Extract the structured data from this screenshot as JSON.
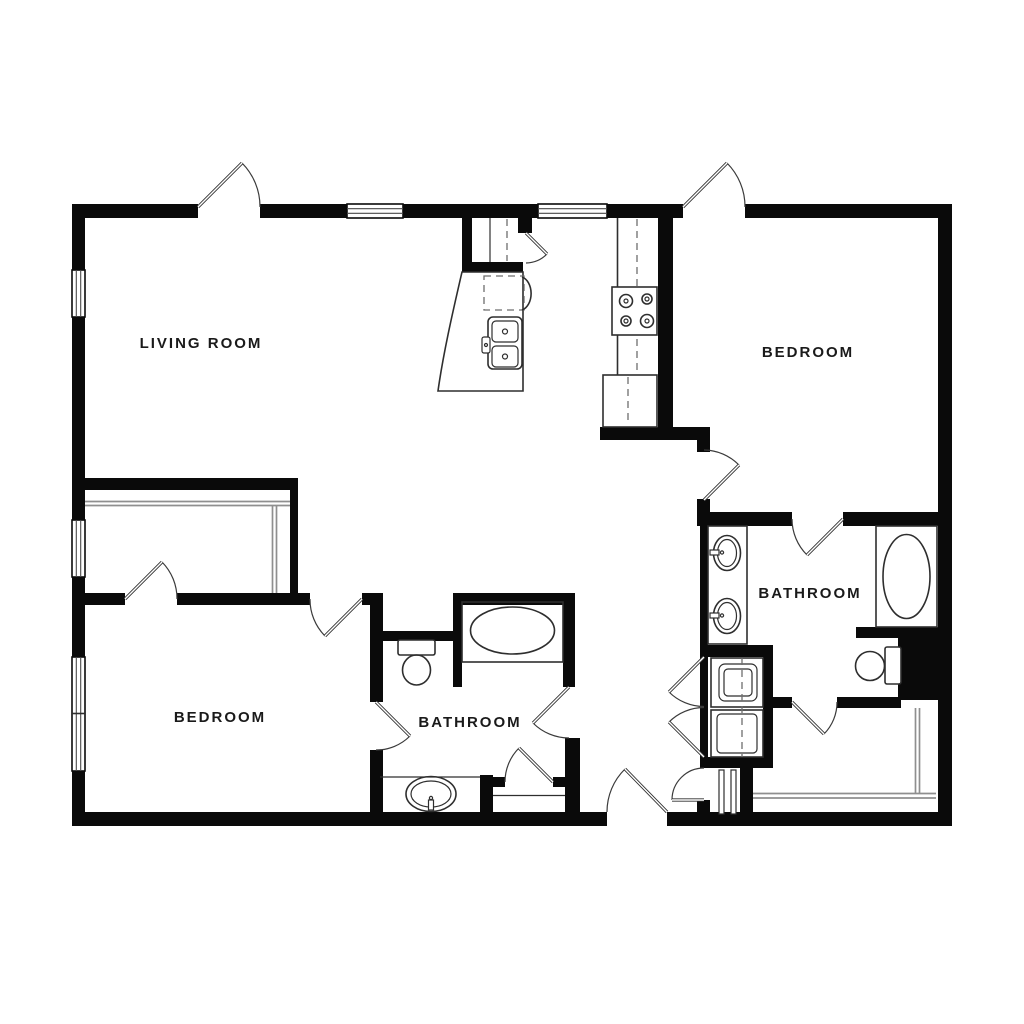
{
  "rooms": [
    {
      "name": "living-room",
      "label": "LIVING ROOM"
    },
    {
      "name": "bedroom-top-right",
      "label": "BEDROOM"
    },
    {
      "name": "bedroom-bottom-left",
      "label": "BEDROOM"
    },
    {
      "name": "bathroom-middle",
      "label": "BATHROOM"
    },
    {
      "name": "bathroom-right",
      "label": "BATHROOM"
    }
  ],
  "fixtures": [
    "entry-door",
    "pantry",
    "kitchen-island-sink",
    "dishwasher",
    "stove",
    "refrigerator",
    "bathtub",
    "toilet",
    "vanity-sink",
    "double-vanity",
    "washer",
    "dryer",
    "closet-shelving",
    "window"
  ],
  "colors": {
    "wall": "#0a0a0a",
    "fixture_line": "#2e2e2e",
    "shelf_line": "#8f8f8f",
    "door_line": "#3a3a3a",
    "background": "#ffffff",
    "label_text": "#1a1a1a"
  }
}
